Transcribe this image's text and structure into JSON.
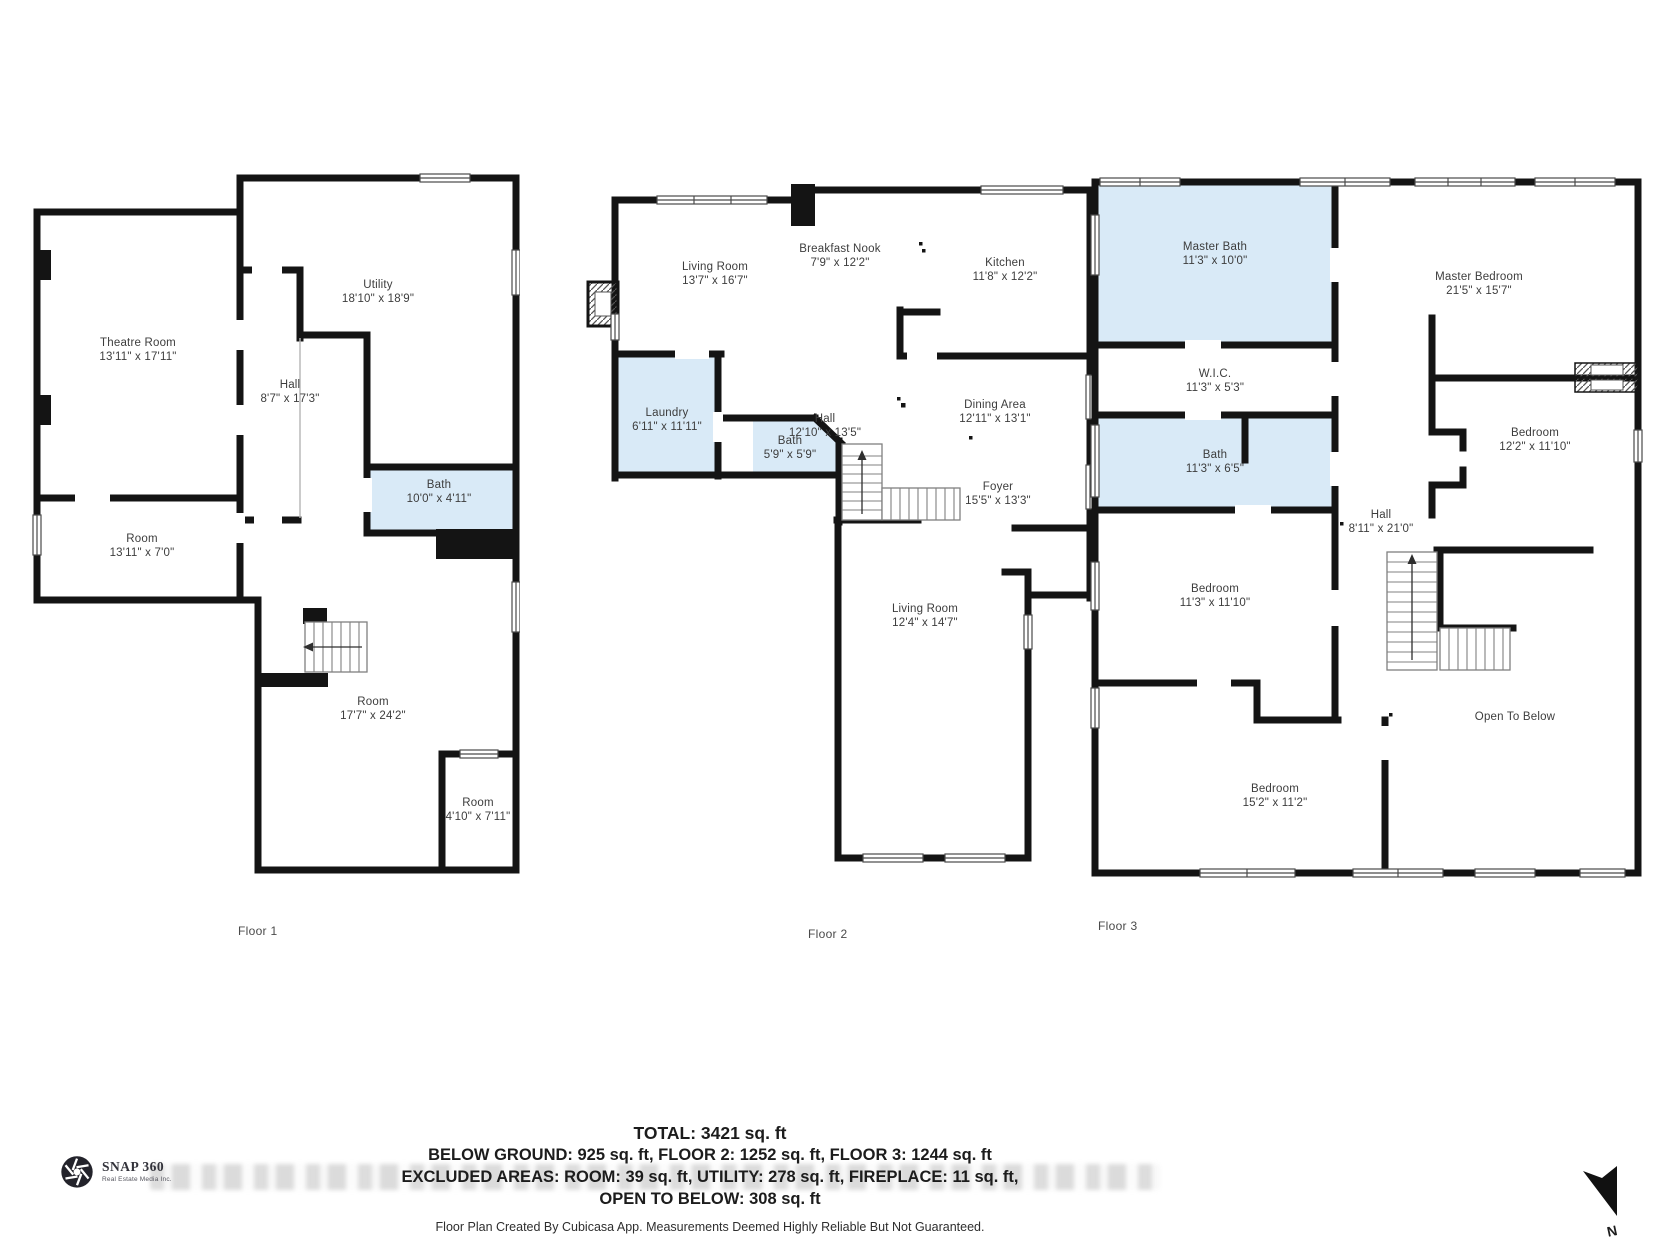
{
  "floors": [
    {
      "label": "Floor 1",
      "rooms": [
        {
          "name": "Theatre Room",
          "dims": "13'11\" x 17'11\""
        },
        {
          "name": "Utility",
          "dims": "18'10\" x 18'9\""
        },
        {
          "name": "Hall",
          "dims": "8'7\" x 17'3\""
        },
        {
          "name": "Bath",
          "dims": "10'0\" x 4'11\""
        },
        {
          "name": "Room",
          "dims": "13'11\" x 7'0\""
        },
        {
          "name": "Room",
          "dims": "17'7\" x 24'2\""
        },
        {
          "name": "Room",
          "dims": "4'10\" x 7'11\""
        }
      ]
    },
    {
      "label": "Floor 2",
      "rooms": [
        {
          "name": "Living Room",
          "dims": "13'7\" x 16'7\""
        },
        {
          "name": "Breakfast Nook",
          "dims": "7'9\" x 12'2\""
        },
        {
          "name": "Kitchen",
          "dims": "11'8\" x 12'2\""
        },
        {
          "name": "Hall",
          "dims": "12'10\" x 13'5\""
        },
        {
          "name": "Dining Area",
          "dims": "12'11\" x 13'1\""
        },
        {
          "name": "Laundry",
          "dims": "6'11\" x 11'11\""
        },
        {
          "name": "Bath",
          "dims": "5'9\" x 5'9\""
        },
        {
          "name": "Foyer",
          "dims": "15'5\" x 13'3\""
        },
        {
          "name": "Living Room",
          "dims": "12'4\" x 14'7\""
        }
      ]
    },
    {
      "label": "Floor 3",
      "rooms": [
        {
          "name": "Master Bath",
          "dims": "11'3\" x 10'0\""
        },
        {
          "name": "Master Bedroom",
          "dims": "21'5\" x 15'7\""
        },
        {
          "name": "W.I.C.",
          "dims": "11'3\" x 5'3\""
        },
        {
          "name": "Bath",
          "dims": "11'3\" x 6'5\""
        },
        {
          "name": "Hall",
          "dims": "8'11\" x 21'0\""
        },
        {
          "name": "Bedroom",
          "dims": "12'2\" x 11'10\""
        },
        {
          "name": "Bedroom",
          "dims": "11'3\" x 11'10\""
        },
        {
          "name": "Bedroom",
          "dims": "15'2\" x 11'2\""
        },
        {
          "name": "Open To Below",
          "dims": ""
        }
      ]
    }
  ],
  "summary": {
    "total": "TOTAL: 3421 sq. ft",
    "by_floor": "BELOW GROUND: 925 sq. ft, FLOOR 2: 1252 sq. ft, FLOOR 3: 1244 sq. ft",
    "excluded": "EXCLUDED AREAS: ROOM: 39 sq. ft, UTILITY: 278 sq. ft, FIREPLACE: 11 sq. ft,",
    "excluded2": "OPEN TO BELOW: 308 sq. ft"
  },
  "footer": {
    "credit": "Floor Plan Created By Cubicasa App. Measurements Deemed Highly Reliable But Not Guaranteed."
  },
  "logo": {
    "brand": "SNAP 360",
    "tagline": "Real Estate Media Inc."
  },
  "compass": {
    "label": "N"
  },
  "colors": {
    "wall": "#141414",
    "wet_room_fill": "#d9eaf7"
  }
}
